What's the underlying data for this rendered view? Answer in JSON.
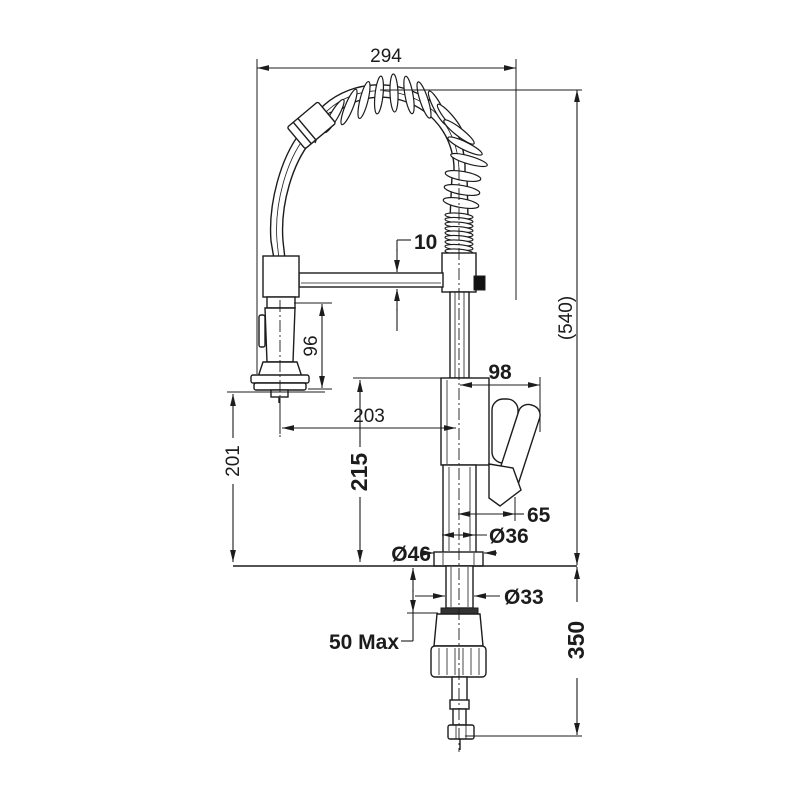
{
  "colors": {
    "background": "#ffffff",
    "line": "#1c1c1c",
    "knob": "#111111"
  },
  "drawing": {
    "kind": "technical dimension drawing of a pull-down spring kitchen mixer tap",
    "dimensions": {
      "overall_width": "294",
      "height_above_counter": "(540)",
      "arm_thickness": "10",
      "spray_head_length": "96",
      "spray_center_to_spout_center": "203",
      "spout_support_height": "215",
      "spray_outlet_height": "201",
      "handle_reach": "98",
      "handle_bottom_offset": "65",
      "body_diameter": "Ø36",
      "flange_diameter": "Ø46",
      "shank_diameter": "Ø33",
      "max_counter_thickness": "50 Max",
      "below_counter_length": "350"
    }
  }
}
